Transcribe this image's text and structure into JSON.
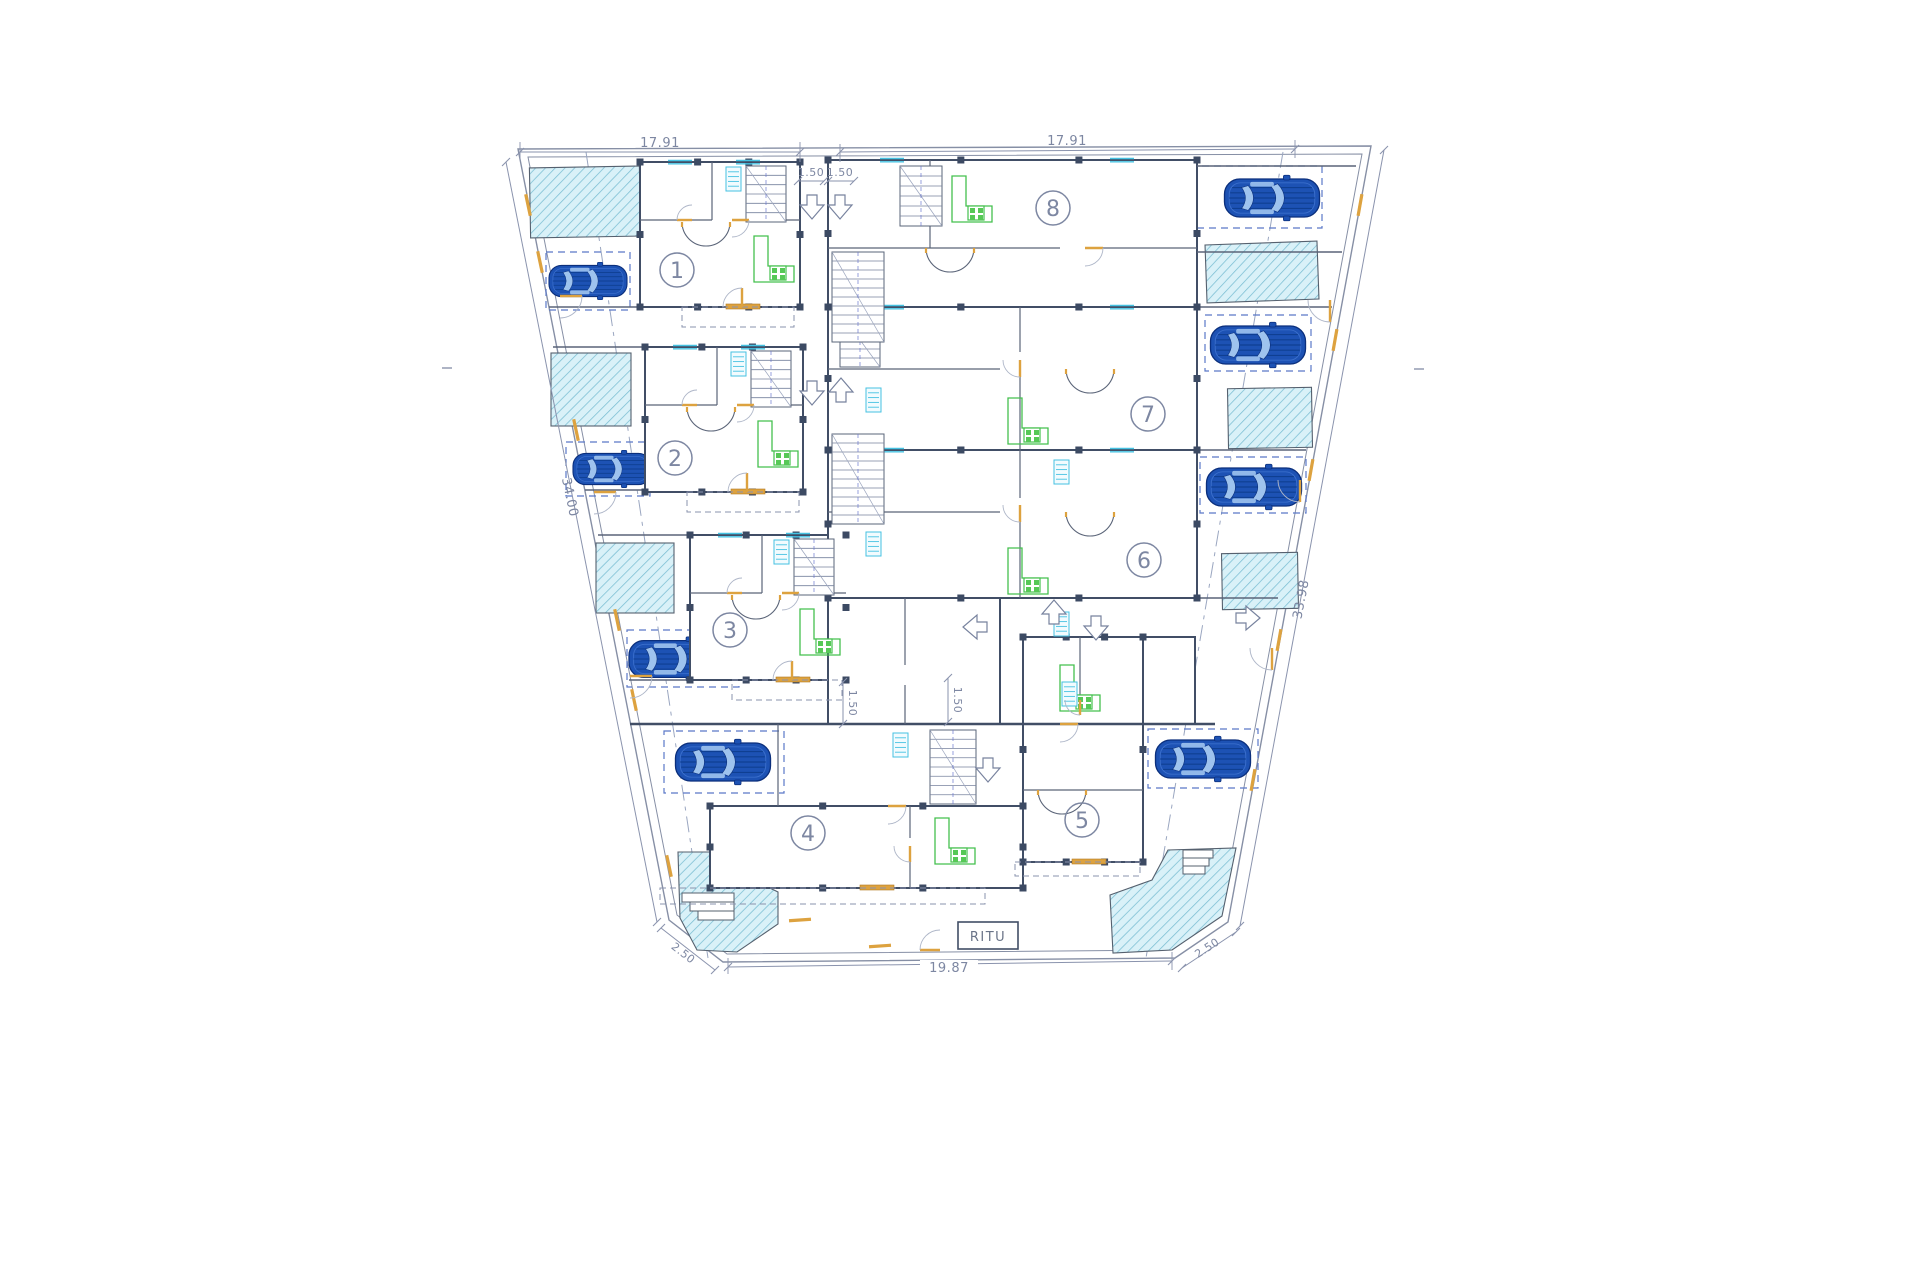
{
  "title": "Residential site floor plan",
  "site": {
    "unit_count": 8,
    "car_count": 8,
    "pool_count": 8
  },
  "units": [
    {
      "number": "1"
    },
    {
      "number": "2"
    },
    {
      "number": "3"
    },
    {
      "number": "4"
    },
    {
      "number": "5"
    },
    {
      "number": "6"
    },
    {
      "number": "7"
    },
    {
      "number": "8"
    }
  ],
  "dimensions": {
    "top_left_width": "17.91",
    "top_right_width": "17.91",
    "top_gap_left": "1.50",
    "top_gap_right": "1.50",
    "left_boundary_length": "34.00",
    "right_boundary_length": "33.98",
    "bottom_width": "19.87",
    "bottom_left_edge": "2.50",
    "bottom_right_edge": "2.50",
    "mid_gap_left": "1.50",
    "mid_gap_right": "1.50"
  },
  "labels": {
    "utility_box": "RITU"
  },
  "colors": {
    "wall": "#414e66",
    "thin": "#77829e",
    "dimension": "#8a93ad",
    "dim_text": "#7d87a2",
    "door_orange": "#dda23f",
    "kitchen_green": "#44c04e",
    "window_cyan": "#45c2e2",
    "car_body": "#1d52b4",
    "car_outline": "#0b2f7c",
    "car_glass": "#9ec3ee",
    "car_stripe": "#0f3f92",
    "pool_fill": "#d9f1f8",
    "pool_hatch": "#79bdd2",
    "parking_dash": "#5a78c8",
    "background": "#ffffff"
  }
}
